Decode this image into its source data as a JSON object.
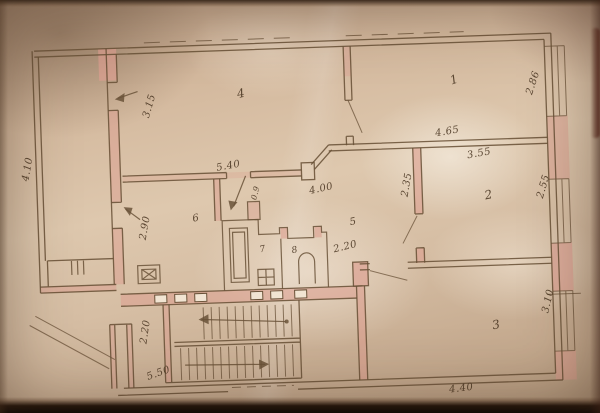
{
  "plan": {
    "rooms": {
      "r1": "1",
      "r2": "2",
      "r3": "3",
      "r4": "4",
      "r5": "5",
      "r6": "6",
      "r7": "7",
      "r8": "8"
    },
    "dims": {
      "balcony": "4.10",
      "room4_w": "3.15",
      "room4_l": "5.40",
      "kitchen": "2.90",
      "corridor_l": "4.00",
      "corridor_w": "2.35",
      "hall": "2.20",
      "door": "0.9",
      "room1_l": "4.65",
      "room1_w": "2.86",
      "room2_l": "3.55",
      "room2_w": "2.55",
      "room3_w": "3.10",
      "room3_l": "4.40",
      "stair_w": "2.20",
      "stair_l": "5.50"
    }
  }
}
